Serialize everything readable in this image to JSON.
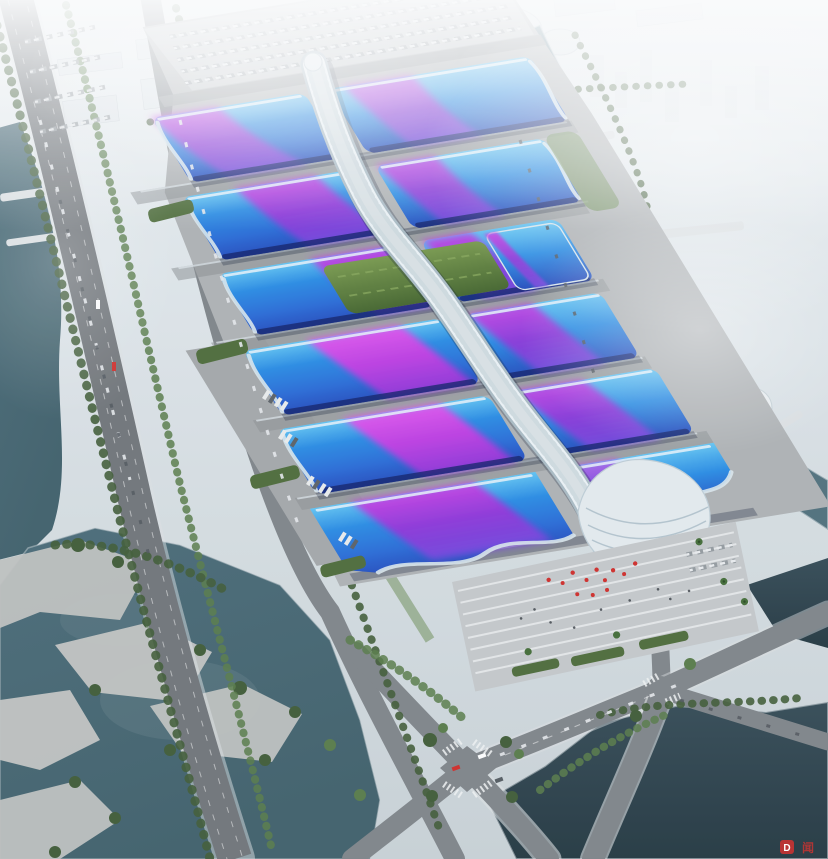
{
  "meta": {
    "title": "Aerial rendering of a riverside exhibition and convention center",
    "description": "Bird's-eye architectural visualization: six pairs of wave-roofed exhibition halls in blue with violet-magenta ribbon graphics, linked by a white serpentine central canopy ending in a shell-shaped entrance hall beside a striped arrival plaza; the campus is ringed by highways, tree-lined avenues, canals and lakes, with a hazy white city skyline beyond.",
    "style": "photorealistic CG render, elevated oblique view, hazy daylight"
  },
  "palette": {
    "sky_top": "#eef2f4",
    "haze_white": "#f6f9fa",
    "city_white": "#e3e8ec",
    "roof_blue_light": "#66c6f4",
    "roof_blue": "#2f8fe6",
    "roof_blue_mid": "#2f6fd8",
    "roof_blue_deep": "#2a50c0",
    "roof_navy_eave": "#16246a",
    "ribbon_pink": "#e755ee",
    "ribbon_magenta": "#cc41e6",
    "ribbon_purple": "#9638da",
    "ribbon_violet": "#7a4be0",
    "spine_white": "#eef4f7",
    "spine_shade": "#aebec7",
    "garden_green": "#4a6a33",
    "lawn_green": "#6a8b52",
    "hedge_green": "#53703f",
    "tree_green": "#46603c",
    "tree_green_light": "#5d7f4e",
    "slab_gray": "#b2b5b7",
    "pavement_light": "#c6c9cb",
    "apron_gray": "#a8abad",
    "road_gray": "#84898d",
    "highway_gray": "#75797d",
    "water_canal": "#50707c",
    "water_lake": "#46656f",
    "water_deep": "#32454e",
    "water_river": "#6d8d99",
    "bridge_white": "#dfe3e5",
    "accent_red": "#d23330"
  },
  "watermark": {
    "logo_text": "D",
    "suffix_text": "闻"
  },
  "scene": {
    "landmarks": [
      "exhibition-hall-rows",
      "central-serpentine-canopy",
      "shell-entrance-hall",
      "arrival-plaza",
      "north-parking-lot",
      "west-truck-apron",
      "rooftop-garden",
      "left-highway",
      "left-canal",
      "southwest-lake",
      "right-river",
      "river-bridges",
      "south-intersection",
      "south-pond",
      "city-skyline"
    ]
  }
}
